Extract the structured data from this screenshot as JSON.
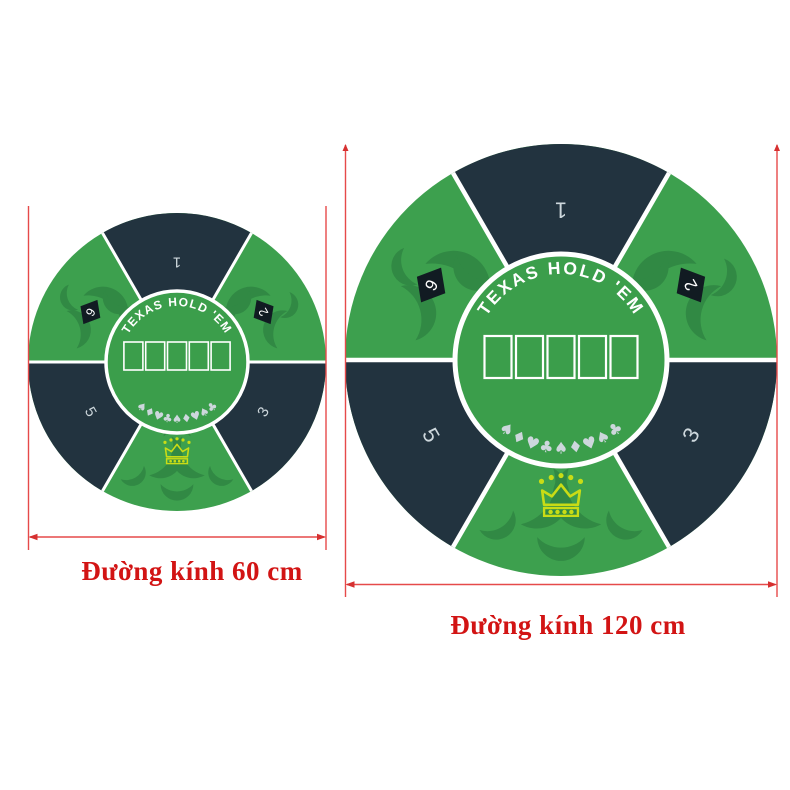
{
  "image": {
    "background": "#ffffff",
    "description": "Two round Texas Hold'em rubber poker table mats shown side by side with red diameter dimension annotations"
  },
  "colors": {
    "green": "#3da04e",
    "green_center": "#3b9e4b",
    "green_ornament": "#318944",
    "navy": "#22333f",
    "diamond_black": "#111b22",
    "number_color": "#cdd7dc",
    "suit_color": "#cdd7dc",
    "crown_yellow": "#c9dc16",
    "dimension_red": "#e64a4a",
    "arrow_red": "#d63030",
    "label_red": "#d21414",
    "white": "#ffffff"
  },
  "mat_design": {
    "title": "TEXAS HOLD 'EM",
    "card_slots": 5,
    "suit_row": [
      "spade",
      "diamond",
      "heart",
      "club",
      "spade",
      "diamond",
      "heart",
      "spade",
      "club"
    ],
    "seats": [
      {
        "label": "1",
        "angle": -90,
        "style": "plain"
      },
      {
        "label": "2",
        "angle": -30,
        "style": "diamond"
      },
      {
        "label": "3",
        "angle": 30,
        "style": "plain"
      },
      {
        "label": "5",
        "angle": 150,
        "style": "plain"
      },
      {
        "label": "6",
        "angle": -150,
        "style": "diamond"
      }
    ],
    "logo": "crown"
  },
  "annotations": {
    "small": {
      "label": "Đường kính 60 cm"
    },
    "large": {
      "label": "Đường kính 120 cm"
    }
  }
}
